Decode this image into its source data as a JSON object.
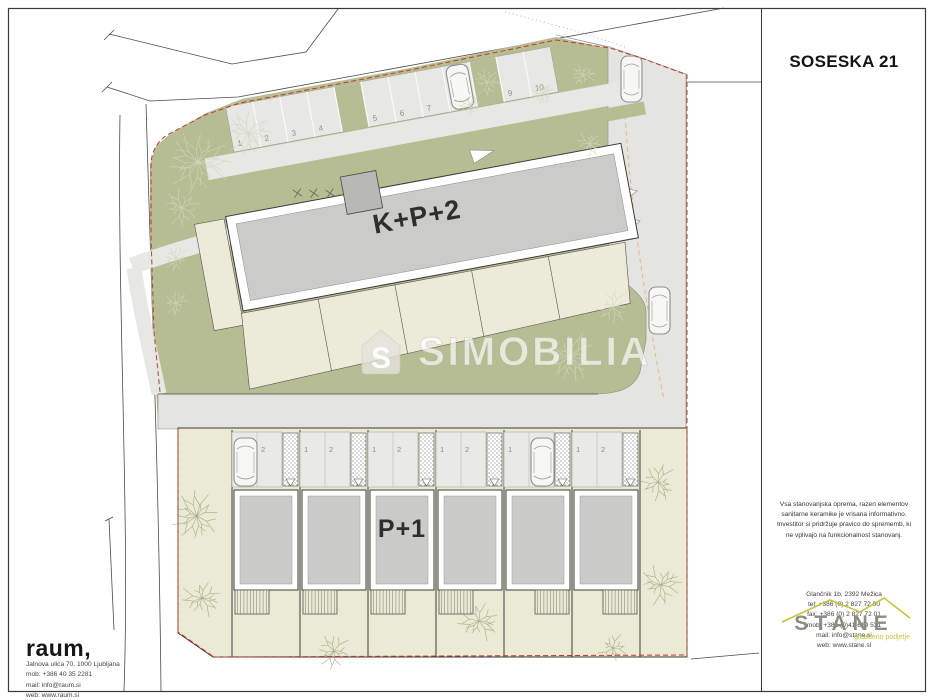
{
  "sheet": {
    "title": "SOSESKA 21"
  },
  "plan": {
    "upper_building_label": "K+P+2",
    "lower_building_label": "P+1",
    "upper_parking_numbers": [
      "1",
      "2",
      "3",
      "4",
      "5",
      "6",
      "7",
      "8",
      "9",
      "10"
    ],
    "lower_unit_parking_numbers": [
      "1",
      "2"
    ],
    "lower_unit_count": 6
  },
  "watermark": {
    "logo_letter": "S",
    "text": "SIMOBILIA"
  },
  "disclaimer": "Vsa stanovanjska oprema, razen elementov sanitarne keramike je vrisana informativno. Investitor si pridržuje pravico do sprememb, ki ne vplivajo na funkcionalnost stanovanj.",
  "architect": {
    "name": "raum,",
    "address": "Jalnova ulica 70, 1000 Ljubljana",
    "mobile": "mob: +386 40 35 2281",
    "email": "mail: info@raum.si",
    "web": "web: www.raum.si"
  },
  "developer": {
    "name": "STANE",
    "tagline": "gradbeno podjetje",
    "address": "Glančnik 1b, 2392 Mežica",
    "tel": "tel: +386 (0) 2 827 72 00",
    "fax": "fax: +386 (0) 2 827 72 01",
    "mobile": "mob: +386 (0)41 619 531",
    "email": "mail: info@stane.si",
    "web": "web: www.stane.si"
  },
  "colors": {
    "boundary_red": "#c0392b",
    "landscape_olive": "#b7bd92",
    "garden_cream": "#eaead5",
    "building_gray": "#cbcbc9",
    "road_gray": "#e4e4e1",
    "accent_olive": "#c2c63f"
  }
}
